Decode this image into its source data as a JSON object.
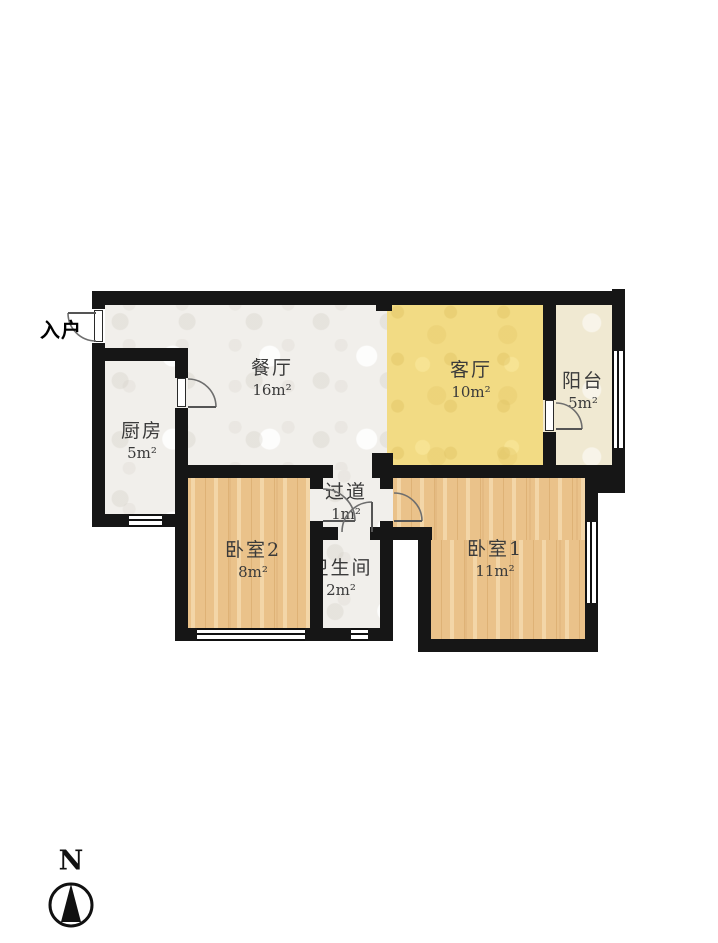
{
  "plan": {
    "entrance_label": "入户",
    "rooms": {
      "dining": {
        "name": "餐厅",
        "area": "16m²"
      },
      "living": {
        "name": "客厅",
        "area": "10m²"
      },
      "balcony": {
        "name": "阳台",
        "area": "5m²"
      },
      "kitchen": {
        "name": "厨房",
        "area": "5m²"
      },
      "hallway": {
        "name": "过道",
        "area": "1m²"
      },
      "bedroom2": {
        "name": "卧室2",
        "area": "8m²"
      },
      "bathroom": {
        "name": "卫生间",
        "area": "2m²"
      },
      "bedroom1": {
        "name": "卧室1",
        "area": "11m²"
      }
    },
    "compass": {
      "north_label": "N"
    },
    "colors": {
      "wall": "#161616",
      "marble_floor": "#f1efeb",
      "living_floor": "#f2db84",
      "balcony_floor": "#f0e9d2",
      "wood_floor": "#eac28a",
      "door_arc": "#6e6e6e"
    }
  }
}
